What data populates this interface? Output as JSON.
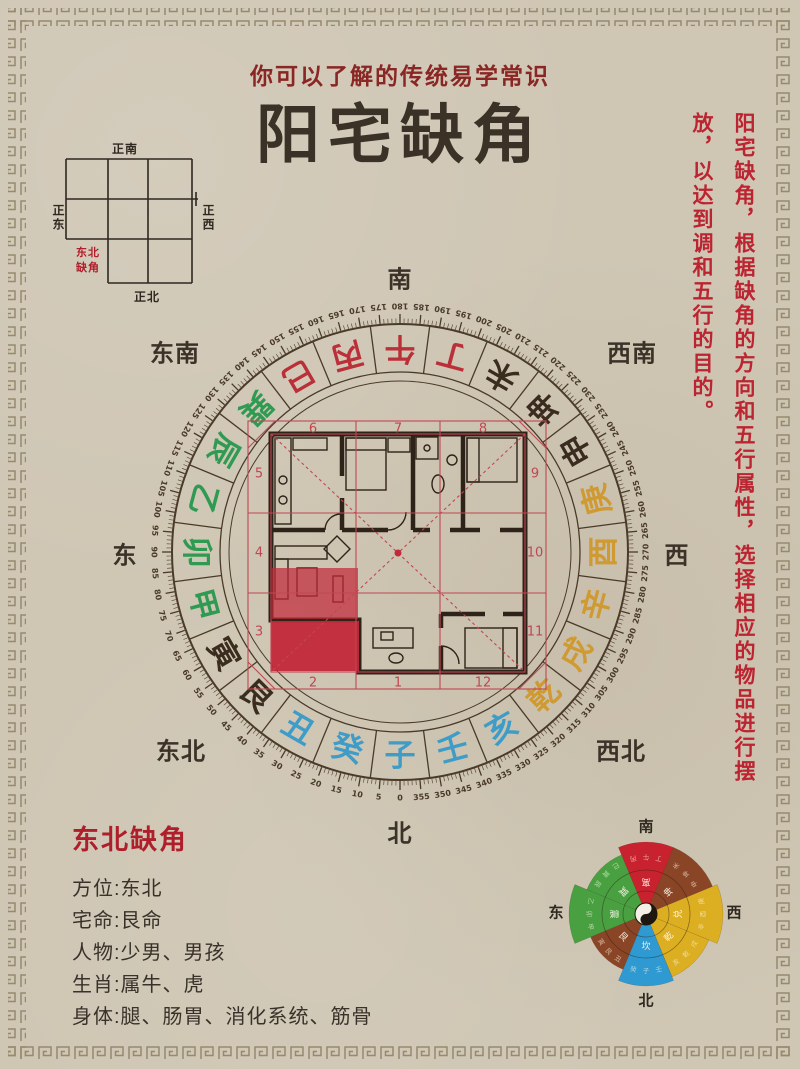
{
  "page": {
    "background_color": "#cfc6b4",
    "border_pattern": "greek-key-meander",
    "border_color": "#968a6e"
  },
  "header": {
    "subtitle": "你可以了解的传统易学常识",
    "title": "阳宅缺角",
    "subtitle_color": "#8a2724",
    "title_color": "#3a3127"
  },
  "mini_grid": {
    "top": "正南",
    "bottom": "正北",
    "left": "正东",
    "right": "正西",
    "missing_label": "东北缺角",
    "missing_label_color": "#b01f2a"
  },
  "side_note": {
    "text": "阳宅缺角，根据缺角的方向和五行属性，选择相应的物品进行摆放，以达到调和五行的目的。",
    "color": "#bb2430"
  },
  "compass": {
    "directions": {
      "top": "南",
      "bottom": "北",
      "left": "东",
      "right": "西",
      "top_left": "东南",
      "top_right": "西南",
      "bottom_left": "东北",
      "bottom_right": "西北"
    },
    "sector_deg": 15,
    "degree_label_step": 5,
    "degree_min": 0,
    "degree_max": 355,
    "ring_line_color": "#4a3a28",
    "palette": {
      "blue": "#3e9cc8",
      "green": "#2f9a52",
      "red": "#bb3038",
      "gold": "#cf9a31",
      "dark": "#3a2d1f"
    },
    "mountains": [
      {
        "name": "子",
        "color": "blue"
      },
      {
        "name": "癸",
        "color": "blue"
      },
      {
        "name": "丑",
        "color": "blue"
      },
      {
        "name": "艮",
        "color": "dark"
      },
      {
        "name": "寅",
        "color": "dark"
      },
      {
        "name": "甲",
        "color": "green"
      },
      {
        "name": "卯",
        "color": "green"
      },
      {
        "name": "乙",
        "color": "green"
      },
      {
        "name": "辰",
        "color": "green"
      },
      {
        "name": "巽",
        "color": "green"
      },
      {
        "name": "巳",
        "color": "red"
      },
      {
        "name": "丙",
        "color": "red"
      },
      {
        "name": "午",
        "color": "red"
      },
      {
        "name": "丁",
        "color": "red"
      },
      {
        "name": "未",
        "color": "dark"
      },
      {
        "name": "坤",
        "color": "dark"
      },
      {
        "name": "申",
        "color": "dark"
      },
      {
        "name": "庚",
        "color": "gold"
      },
      {
        "name": "酉",
        "color": "gold"
      },
      {
        "name": "辛",
        "color": "gold"
      },
      {
        "name": "戌",
        "color": "gold"
      },
      {
        "name": "乾",
        "color": "gold"
      },
      {
        "name": "亥",
        "color": "blue"
      },
      {
        "name": "壬",
        "color": "blue"
      }
    ]
  },
  "floorplan": {
    "sector_numbers": [
      "1",
      "2",
      "3",
      "4",
      "5",
      "6",
      "7",
      "8",
      "9",
      "10",
      "11",
      "12"
    ],
    "grid_color": "#c04752",
    "highlight_color": "#c2293a",
    "wall_color": "#2e2318"
  },
  "info": {
    "heading": "东北缺角",
    "rows": [
      "方位:东北",
      "宅命:艮命",
      "人物:少男、男孩",
      "生肖:属牛、虎",
      "身体:腿、肠胃、消化系统、筋骨"
    ]
  },
  "bagua": {
    "labels": {
      "top": "南",
      "bottom": "北",
      "left": "东",
      "right": "西"
    },
    "palette": {
      "red": "#c9222f",
      "brown": "#8a4526",
      "gold": "#dcae22",
      "blue": "#2f9ad2",
      "green": "#49a040"
    },
    "sectors": [
      {
        "dir": "S",
        "trigram": "离",
        "mountains": "丙午丁",
        "color": "red",
        "r": 72
      },
      {
        "dir": "SW",
        "trigram": "坤",
        "mountains": "未坤申",
        "color": "brown",
        "r": 72
      },
      {
        "dir": "W",
        "trigram": "兑",
        "mountains": "庚酉辛",
        "color": "gold",
        "r": 77
      },
      {
        "dir": "NW",
        "trigram": "乾",
        "mountains": "戌乾亥",
        "color": "gold",
        "r": 68
      },
      {
        "dir": "N",
        "trigram": "坎",
        "mountains": "壬子癸",
        "color": "blue",
        "r": 72
      },
      {
        "dir": "NE",
        "trigram": "艮",
        "mountains": "丑艮寅",
        "color": "brown",
        "r": 60
      },
      {
        "dir": "E",
        "trigram": "震",
        "mountains": "甲卯乙",
        "color": "green",
        "r": 77
      },
      {
        "dir": "SE",
        "trigram": "巽",
        "mountains": "辰巽巳",
        "color": "green",
        "r": 64
      }
    ]
  }
}
